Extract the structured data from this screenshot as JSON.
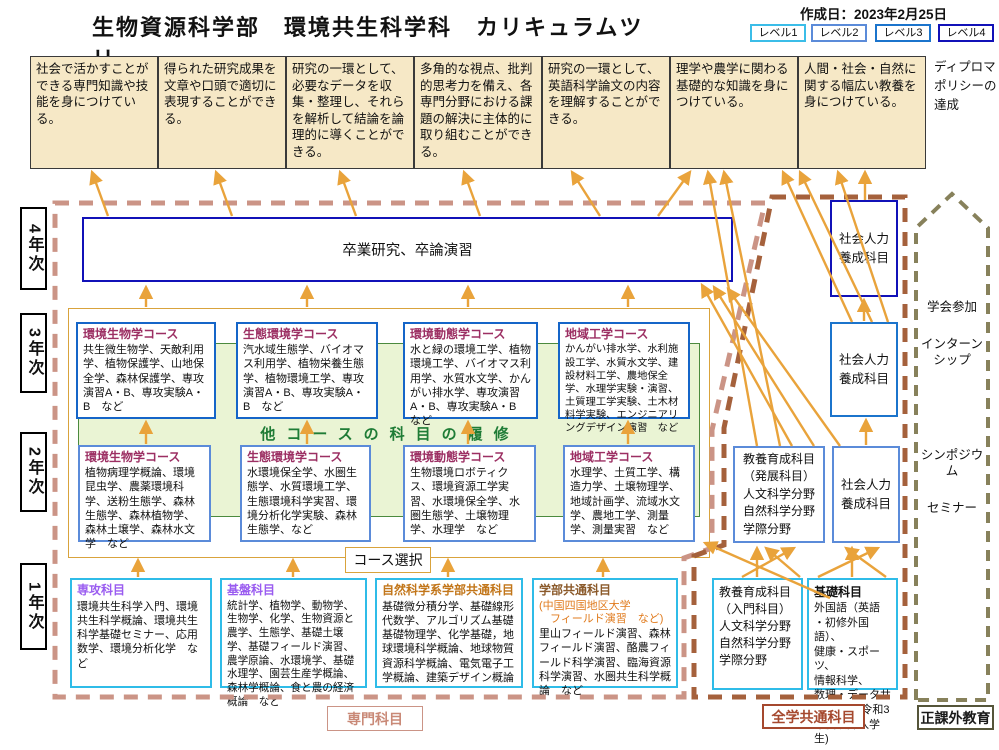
{
  "header": {
    "title": "生物資源科学部　環境共生科学科　カリキュラムツリー",
    "created": "作成日：2023年2月25日",
    "levels": [
      {
        "label": "レベル1",
        "color": "#3bbde8"
      },
      {
        "label": "レベル2",
        "color": "#5b8bd9"
      },
      {
        "label": "レベル3",
        "color": "#1b74cc"
      },
      {
        "label": "レベル4",
        "color": "#1111b8"
      }
    ]
  },
  "diploma": {
    "note": "ディプロマ\nポリシーの\n達成",
    "outcomes": [
      "社会で活かすことができる専門知識や技能を身につけている。",
      "得られた研究成果を文章や口頭で適切に表現することができる。",
      "研究の一環として、必要なデータを収集・整理し、それらを解析して結論を論理的に導くことができる。",
      "多角的な視点、批判的思考力を備え、各専門分野における課題の解決に主体的に取り組むことができる。",
      "研究の一環として、英語科学論文の内容を理解することができる。",
      "理学や農学に関わる基礎的な知識を身につけている。",
      "人間・社会・自然に関する幅広い教養を身につけている。"
    ]
  },
  "years": {
    "y4": "4年次",
    "y3": "3年次",
    "y2": "2年次",
    "y1": "1年次"
  },
  "graduation": {
    "label": "卒業研究、卒論演習"
  },
  "band": {
    "label": "他コースの科目の履修"
  },
  "course_select": {
    "label": "コース選択"
  },
  "courses_y3": [
    {
      "name": "環境生物学コース",
      "subjects": "共生微生物学、天敵利用学、植物保護学、山地保全学、森林保護学、専攻演習A・B、専攻実験A・B　など"
    },
    {
      "name": "生態環境学コース",
      "subjects": "汽水域生態学、バイオマス利用学、植物栄養生態学、植物環境工学、専攻演習A・B、専攻実験A・B　など"
    },
    {
      "name": "環境動態学コース",
      "subjects": "水と緑の環境工学、植物環境工学、バイオマス利用学、水質水文学、かんがい排水学、専攻演習A・B、専攻実験A・B　など"
    },
    {
      "name": "地域工学コース",
      "subjects": "かんがい排水学、水利施設工学、水質水文学、建設材料工学、農地保全学、水理学実験・演習、土質理工学実験、土木材料学実験、エンジニアリングデザイン演習　など"
    }
  ],
  "courses_y2": [
    {
      "name": "環境生物学コース",
      "subjects": "植物病理学概論、環境昆虫学、農薬環境科学、送粉生態学、森林生態学、森林植物学、森林土壌学、森林水文学　など"
    },
    {
      "name": "生態環境学コース",
      "subjects": "水環境保全学、水圏生態学、水質環境工学、生態環境科学実習、環境分析化学実験、森林生態学、など"
    },
    {
      "name": "環境動態学コース",
      "subjects": "生物環境ロボティクス、環境資源工学実習、水環境保全学、水圏生態学、土壌物理学、水理学　など"
    },
    {
      "name": "地域工学コース",
      "subjects": "水理学、土質工学、構造力学、土壌物理学、地域計画学、流域水文学、農地工学、測量学、測量実習　など"
    }
  ],
  "y1_boxes": [
    {
      "title": "専攻科目",
      "body": "環境共生科学入門、環境共生科学概論、環境共生科学基礎セミナー、応用数学、環境分析化学　など"
    },
    {
      "title": "基盤科目",
      "body": "統計学、植物学、動物学、生物学、化学、生物資源と農学、生態学、基礎土壌学、基礎フィールド演習、農学原論、水環境学、基礎水理学、園芸生産学概論、森林学概論、食と農の経済概論　など"
    },
    {
      "title": "自然科学系学部共通科目",
      "body": "基礎微分積分学、基礎線形代数学、アルゴリズム基礎　基礎物理学、化学基礎，地球環境科学概論、地球物質資源科学概論、電気電子工学概論、建築デザイン概論"
    },
    {
      "title": "学部共通科目",
      "note": "(中国四国地区大学\n　フィールド演習　など)",
      "body": "里山フィールド演習、森林フィールド演習、酪農フィールド科学演習、臨海資源科学演習、水圏共生科学概論　など"
    }
  ],
  "right_column": {
    "shakaijinryoku_l4": "社会人力\n養成科目",
    "shakaijinryoku_l3": "社会人力\n養成科目",
    "kyoyo_hatten": "教養育成科目\n（発展科目）\n人文科学分野\n自然科学分野\n学際分野",
    "shakaijinryoku_l2": "社会人力\n養成科目",
    "kyoyo_nyumon": "教養育成科目\n（入門科目）\n人文科学分野\n自然科学分野\n学際分野",
    "kiso_title": "基礎科目",
    "kiso_body": "外国語（英語\n・初修外国語）、\n健康・スポーツ、\n情報科学、\n数理・データサ\nイエンス(令和3\n年度以降入学生)"
  },
  "extracurricular": {
    "items": [
      "学会参加",
      "インターン\nシップ",
      "シンポジウム",
      "セミナー"
    ]
  },
  "section_labels": {
    "senmon": "専門科目",
    "zengaku": "全学共通科目",
    "seikagai": "正課外教育"
  },
  "colors": {
    "arrow": "#e9a33b",
    "senmon_region": "#cb9486",
    "zengaku_region": "#a5613c",
    "seikagai_region": "#87815b",
    "dp_box_fill": "#f6e8c6",
    "band_fill": "#eaf4d4",
    "course_title": "#9c2f63"
  }
}
